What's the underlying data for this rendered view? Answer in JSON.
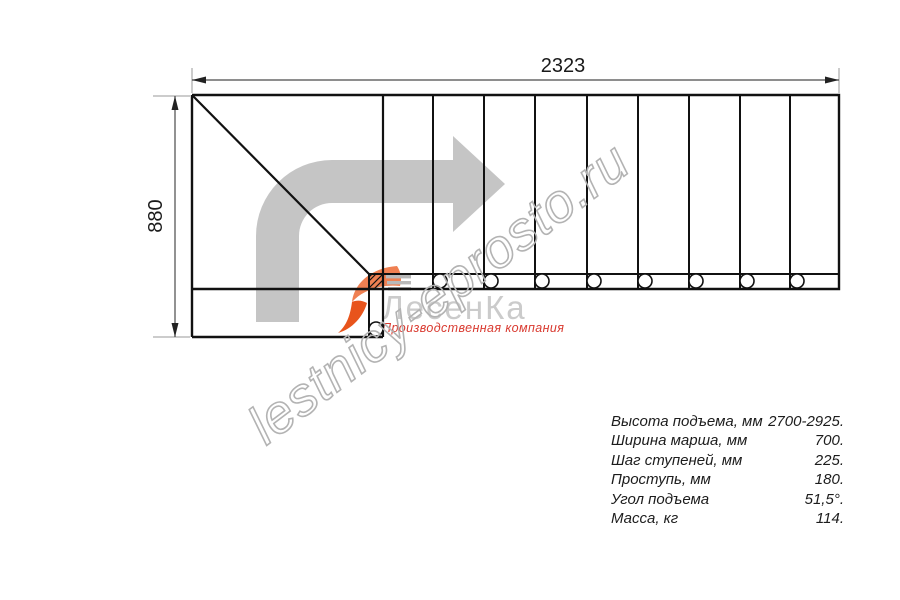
{
  "drawing": {
    "width_label": "2323",
    "height_label": "880"
  },
  "watermark": {
    "text": "lestnicy-eprosto.ru"
  },
  "logo": {
    "name": "ЛесенКа",
    "tagline": "Производственная компания"
  },
  "specs": {
    "rows": [
      {
        "label": "Высота подъема, мм",
        "value": "2700-2925."
      },
      {
        "label": "Ширина марша, мм",
        "value": "700."
      },
      {
        "label": "Шаг ступеней, мм",
        "value": "225."
      },
      {
        "label": "Проступь, мм",
        "value": "180."
      },
      {
        "label": "Угол подъема",
        "value": "51,5°."
      },
      {
        "label": "Масса, кг",
        "value": "114."
      }
    ]
  },
  "colors": {
    "line": "#111111",
    "dimension": "#4a4a4a",
    "extension": "#9a9a9a",
    "arrow_gray": "#c5c5c5",
    "logo_gray": "#cbcbcb",
    "logo_orange": "#e8541c",
    "tagline_red": "#d93a30",
    "watermark_gray": "#b3b3b3"
  }
}
